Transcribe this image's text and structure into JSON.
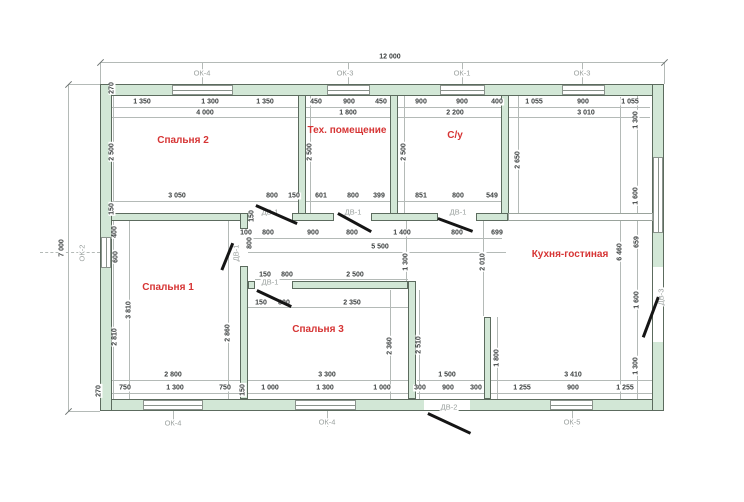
{
  "title": "План дома 12000 x 7000",
  "colors": {
    "wall_fill": "#d2e7d6",
    "wall_edge": "#5c6b5e",
    "dim_line": "#b4bab7",
    "dim_text": "#3c4040",
    "room_label": "#d63434",
    "axis_tag": "#9aa09e",
    "door_line": "#151515",
    "background": "#ffffff"
  },
  "plan": {
    "overall": {
      "width_mm": "12 000",
      "height_mm": "7 000"
    },
    "room_labels": [
      {
        "t": "Спальня 2",
        "x": 183,
        "y": 141
      },
      {
        "t": "Тех. помещение",
        "x": 347,
        "y": 131
      },
      {
        "t": "С/у",
        "x": 455,
        "y": 136
      },
      {
        "t": "Кухня-гостиная",
        "x": 570,
        "y": 255
      },
      {
        "t": "Спальня 1",
        "x": 168,
        "y": 288
      },
      {
        "t": "Спальня 3",
        "x": 318,
        "y": 330
      }
    ],
    "walls": [
      {
        "x": 100,
        "y": 84,
        "w": 564,
        "h": 12
      },
      {
        "x": 100,
        "y": 399,
        "w": 564,
        "h": 12
      },
      {
        "x": 100,
        "y": 84,
        "w": 12,
        "h": 327
      },
      {
        "x": 652,
        "y": 84,
        "w": 12,
        "h": 327
      },
      {
        "x": 298,
        "y": 95,
        "w": 8,
        "h": 126
      },
      {
        "x": 390,
        "y": 95,
        "w": 8,
        "h": 126
      },
      {
        "x": 501,
        "y": 95,
        "w": 8,
        "h": 126
      },
      {
        "x": 111,
        "y": 213,
        "w": 143,
        "h": 8
      },
      {
        "x": 292,
        "y": 213,
        "w": 42,
        "h": 8
      },
      {
        "x": 371,
        "y": 213,
        "w": 67,
        "h": 8
      },
      {
        "x": 476,
        "y": 213,
        "w": 32,
        "h": 8
      },
      {
        "x": 240,
        "y": 213,
        "w": 8,
        "h": 16
      },
      {
        "x": 240,
        "y": 266,
        "w": 8,
        "h": 133
      },
      {
        "x": 248,
        "y": 281,
        "w": 7,
        "h": 8
      },
      {
        "x": 292,
        "y": 281,
        "w": 116,
        "h": 8
      },
      {
        "x": 408,
        "y": 281,
        "w": 8,
        "h": 118
      },
      {
        "x": 484,
        "y": 317,
        "w": 7,
        "h": 82
      }
    ],
    "windows": [
      {
        "name": "ОК-4 top",
        "x": 172,
        "y": 85,
        "w": 61,
        "h": 10,
        "o": "h"
      },
      {
        "name": "ОК-3 top",
        "x": 327,
        "y": 85,
        "w": 43,
        "h": 10,
        "o": "h"
      },
      {
        "name": "ОК-1 top",
        "x": 440,
        "y": 85,
        "w": 45,
        "h": 10,
        "o": "h"
      },
      {
        "name": "ОК-3 top-2",
        "x": 562,
        "y": 85,
        "w": 43,
        "h": 10,
        "o": "h"
      },
      {
        "name": "ОК-4 bottom",
        "x": 143,
        "y": 400,
        "w": 60,
        "h": 10,
        "o": "h"
      },
      {
        "name": "ОК-4 bottom-2",
        "x": 295,
        "y": 400,
        "w": 61,
        "h": 10,
        "o": "h"
      },
      {
        "name": "ОК-5 bottom",
        "x": 550,
        "y": 400,
        "w": 43,
        "h": 10,
        "o": "h"
      },
      {
        "name": "ОК-2 left",
        "x": 101,
        "y": 237,
        "w": 10,
        "h": 31,
        "o": "v"
      },
      {
        "name": "окно right",
        "x": 653,
        "y": 157,
        "w": 10,
        "h": 76,
        "o": "v"
      }
    ],
    "openings": [
      {
        "name": "ДВ-2 проём",
        "x": 424,
        "y": 400,
        "w": 46,
        "h": 10
      },
      {
        "name": "ДВ-3 проём",
        "x": 653,
        "y": 267,
        "w": 10,
        "h": 75
      },
      {
        "name": "проём кухни",
        "x": 508,
        "y": 213,
        "w": 145,
        "h": 8,
        "b": 1
      }
    ],
    "doors": [
      {
        "name": "ДВ-1 спальня 2",
        "x1": 256,
        "y1": 204,
        "x2": 297,
        "y2": 222
      },
      {
        "name": "ДВ-1 тех.помещение",
        "x1": 338,
        "y1": 212,
        "x2": 371,
        "y2": 230
      },
      {
        "name": "ДВ-1 с/у",
        "x1": 438,
        "y1": 217,
        "x2": 473,
        "y2": 230
      },
      {
        "name": "ДВ-1 спальня 1",
        "x1": 233,
        "y1": 242,
        "x2": 222,
        "y2": 269
      },
      {
        "name": "ДВ-1 спальня 3",
        "x1": 257,
        "y1": 289,
        "x2": 291,
        "y2": 305
      },
      {
        "name": "ДВ-3 вход справа",
        "x1": 643,
        "y1": 336,
        "x2": 658,
        "y2": 296
      },
      {
        "name": "ДВ-2 вход снизу",
        "x1": 428,
        "y1": 412,
        "x2": 471,
        "y2": 432
      }
    ],
    "dims": [
      {
        "t": "12 000",
        "x": 390,
        "y": 57
      },
      {
        "t": "1 350",
        "x": 142,
        "y": 102
      },
      {
        "t": "1 300",
        "x": 210,
        "y": 102
      },
      {
        "t": "1 350",
        "x": 265,
        "y": 102
      },
      {
        "t": "450",
        "x": 316,
        "y": 102
      },
      {
        "t": "900",
        "x": 349,
        "y": 102
      },
      {
        "t": "450",
        "x": 381,
        "y": 102
      },
      {
        "t": "900",
        "x": 421,
        "y": 102
      },
      {
        "t": "900",
        "x": 462,
        "y": 102
      },
      {
        "t": "400",
        "x": 497,
        "y": 102
      },
      {
        "t": "1 055",
        "x": 534,
        "y": 102
      },
      {
        "t": "900",
        "x": 583,
        "y": 102
      },
      {
        "t": "1 055",
        "x": 630,
        "y": 102
      },
      {
        "t": "4 000",
        "x": 205,
        "y": 113
      },
      {
        "t": "1 800",
        "x": 348,
        "y": 113
      },
      {
        "t": "2 200",
        "x": 455,
        "y": 113
      },
      {
        "t": "3 010",
        "x": 586,
        "y": 113
      },
      {
        "t": "3 050",
        "x": 177,
        "y": 196
      },
      {
        "t": "800",
        "x": 272,
        "y": 196
      },
      {
        "t": "150",
        "x": 294,
        "y": 196
      },
      {
        "t": "601",
        "x": 321,
        "y": 196
      },
      {
        "t": "800",
        "x": 353,
        "y": 196
      },
      {
        "t": "399",
        "x": 379,
        "y": 196
      },
      {
        "t": "851",
        "x": 421,
        "y": 196
      },
      {
        "t": "800",
        "x": 458,
        "y": 196
      },
      {
        "t": "549",
        "x": 492,
        "y": 196
      },
      {
        "t": "100",
        "x": 246,
        "y": 233
      },
      {
        "t": "800",
        "x": 268,
        "y": 233
      },
      {
        "t": "900",
        "x": 313,
        "y": 233
      },
      {
        "t": "800",
        "x": 352,
        "y": 233
      },
      {
        "t": "1 400",
        "x": 402,
        "y": 233
      },
      {
        "t": "800",
        "x": 457,
        "y": 233
      },
      {
        "t": "699",
        "x": 497,
        "y": 233
      },
      {
        "t": "5 500",
        "x": 380,
        "y": 247
      },
      {
        "t": "150",
        "x": 265,
        "y": 275
      },
      {
        "t": "800",
        "x": 287,
        "y": 275
      },
      {
        "t": "2 500",
        "x": 355,
        "y": 275
      },
      {
        "t": "150",
        "x": 261,
        "y": 303
      },
      {
        "t": "800",
        "x": 284,
        "y": 303
      },
      {
        "t": "2 350",
        "x": 352,
        "y": 303
      },
      {
        "t": "2 800",
        "x": 173,
        "y": 375
      },
      {
        "t": "3 300",
        "x": 327,
        "y": 375
      },
      {
        "t": "1 500",
        "x": 447,
        "y": 375
      },
      {
        "t": "3 410",
        "x": 573,
        "y": 375
      },
      {
        "t": "750",
        "x": 125,
        "y": 388
      },
      {
        "t": "1 300",
        "x": 175,
        "y": 388
      },
      {
        "t": "750",
        "x": 225,
        "y": 388
      },
      {
        "t": "1 000",
        "x": 270,
        "y": 388
      },
      {
        "t": "1 300",
        "x": 325,
        "y": 388
      },
      {
        "t": "1 000",
        "x": 382,
        "y": 388
      },
      {
        "t": "300",
        "x": 420,
        "y": 388
      },
      {
        "t": "900",
        "x": 448,
        "y": 388
      },
      {
        "t": "300",
        "x": 476,
        "y": 388
      },
      {
        "t": "1 255",
        "x": 522,
        "y": 388
      },
      {
        "t": "900",
        "x": 573,
        "y": 388
      },
      {
        "t": "1 255",
        "x": 625,
        "y": 388
      },
      {
        "t": "7 000",
        "x": 62,
        "y": 248,
        "r": 1
      },
      {
        "t": "270",
        "x": 112,
        "y": 88,
        "r": 1
      },
      {
        "t": "2 500",
        "x": 112,
        "y": 152,
        "r": 1
      },
      {
        "t": "150",
        "x": 112,
        "y": 209,
        "r": 1
      },
      {
        "t": "400",
        "x": 115,
        "y": 232,
        "r": 1
      },
      {
        "t": "600",
        "x": 116,
        "y": 257,
        "r": 1
      },
      {
        "t": "2 810",
        "x": 115,
        "y": 337,
        "r": 1
      },
      {
        "t": "3 810",
        "x": 129,
        "y": 310,
        "r": 1
      },
      {
        "t": "270",
        "x": 99,
        "y": 391,
        "r": 1
      },
      {
        "t": "150",
        "x": 243,
        "y": 390,
        "r": 1
      },
      {
        "t": "2 500",
        "x": 310,
        "y": 152,
        "r": 1
      },
      {
        "t": "2 500",
        "x": 404,
        "y": 152,
        "r": 1
      },
      {
        "t": "2 650",
        "x": 518,
        "y": 160,
        "r": 1
      },
      {
        "t": "1 300",
        "x": 636,
        "y": 120,
        "r": 1
      },
      {
        "t": "1 600",
        "x": 636,
        "y": 196,
        "r": 1
      },
      {
        "t": "6 460",
        "x": 620,
        "y": 252,
        "r": 1
      },
      {
        "t": "659",
        "x": 637,
        "y": 242,
        "r": 1
      },
      {
        "t": "1 600",
        "x": 637,
        "y": 300,
        "r": 1
      },
      {
        "t": "1 300",
        "x": 636,
        "y": 366,
        "r": 1
      },
      {
        "t": "1 300",
        "x": 406,
        "y": 262,
        "r": 1
      },
      {
        "t": "2 010",
        "x": 483,
        "y": 262,
        "r": 1
      },
      {
        "t": "2 860",
        "x": 228,
        "y": 333,
        "r": 1
      },
      {
        "t": "2 360",
        "x": 390,
        "y": 346,
        "r": 1
      },
      {
        "t": "2 510",
        "x": 419,
        "y": 345,
        "r": 1
      },
      {
        "t": "1 800",
        "x": 497,
        "y": 358,
        "r": 1
      },
      {
        "t": "150",
        "x": 252,
        "y": 216,
        "r": 1
      },
      {
        "t": "800",
        "x": 250,
        "y": 243,
        "r": 1
      }
    ],
    "tags": [
      {
        "t": "ОК-4",
        "x": 202,
        "y": 73
      },
      {
        "t": "ОК-3",
        "x": 345,
        "y": 73
      },
      {
        "t": "ОК-1",
        "x": 462,
        "y": 73
      },
      {
        "t": "ОК-3",
        "x": 582,
        "y": 73
      },
      {
        "t": "ОК-2",
        "x": 82,
        "y": 253,
        "r": 1
      },
      {
        "t": "ОК-4",
        "x": 173,
        "y": 423
      },
      {
        "t": "ОК-4",
        "x": 327,
        "y": 422
      },
      {
        "t": "ОК-5",
        "x": 572,
        "y": 422
      },
      {
        "t": "ДВ-2",
        "x": 449,
        "y": 407
      },
      {
        "t": "ДВ-1",
        "x": 270,
        "y": 212
      },
      {
        "t": "ДВ-1",
        "x": 353,
        "y": 212
      },
      {
        "t": "ДВ-1",
        "x": 458,
        "y": 212
      },
      {
        "t": "ДВ-1",
        "x": 236,
        "y": 253,
        "r": 1
      },
      {
        "t": "ДВ-1",
        "x": 270,
        "y": 282
      },
      {
        "t": "ДВ-3",
        "x": 661,
        "y": 297,
        "r": 1
      }
    ],
    "dlines": [
      {
        "x": 100,
        "y": 62,
        "w": 564,
        "h": 1
      },
      {
        "x": 68,
        "y": 84,
        "w": 1,
        "h": 327
      },
      {
        "x": 111,
        "y": 107,
        "w": 188,
        "h": 1
      },
      {
        "x": 306,
        "y": 107,
        "w": 85,
        "h": 1
      },
      {
        "x": 398,
        "y": 107,
        "w": 104,
        "h": 1
      },
      {
        "x": 508,
        "y": 107,
        "w": 142,
        "h": 1
      },
      {
        "x": 111,
        "y": 117,
        "w": 188,
        "h": 1
      },
      {
        "x": 306,
        "y": 117,
        "w": 85,
        "h": 1
      },
      {
        "x": 398,
        "y": 117,
        "w": 104,
        "h": 1
      },
      {
        "x": 508,
        "y": 117,
        "w": 142,
        "h": 1
      },
      {
        "x": 111,
        "y": 201,
        "w": 188,
        "h": 1
      },
      {
        "x": 306,
        "y": 201,
        "w": 85,
        "h": 1
      },
      {
        "x": 398,
        "y": 201,
        "w": 104,
        "h": 1
      },
      {
        "x": 248,
        "y": 238,
        "w": 254,
        "h": 1
      },
      {
        "x": 248,
        "y": 252,
        "w": 258,
        "h": 1
      },
      {
        "x": 255,
        "y": 279,
        "w": 153,
        "h": 1
      },
      {
        "x": 248,
        "y": 307,
        "w": 160,
        "h": 1
      },
      {
        "x": 111,
        "y": 380,
        "w": 130,
        "h": 1
      },
      {
        "x": 248,
        "y": 380,
        "w": 160,
        "h": 1
      },
      {
        "x": 417,
        "y": 380,
        "w": 68,
        "h": 1
      },
      {
        "x": 490,
        "y": 380,
        "w": 163,
        "h": 1
      },
      {
        "x": 111,
        "y": 393,
        "w": 130,
        "h": 1
      },
      {
        "x": 248,
        "y": 393,
        "w": 160,
        "h": 1
      },
      {
        "x": 417,
        "y": 393,
        "w": 68,
        "h": 1
      },
      {
        "x": 490,
        "y": 393,
        "w": 163,
        "h": 1
      },
      {
        "x": 113,
        "y": 95,
        "w": 1,
        "h": 304
      },
      {
        "x": 129,
        "y": 219,
        "w": 1,
        "h": 180
      },
      {
        "x": 310,
        "y": 95,
        "w": 1,
        "h": 118
      },
      {
        "x": 404,
        "y": 95,
        "w": 1,
        "h": 118
      },
      {
        "x": 518,
        "y": 95,
        "w": 1,
        "h": 118
      },
      {
        "x": 620,
        "y": 97,
        "w": 1,
        "h": 302
      },
      {
        "x": 637,
        "y": 95,
        "w": 1,
        "h": 304
      },
      {
        "x": 406,
        "y": 221,
        "w": 1,
        "h": 60
      },
      {
        "x": 483,
        "y": 221,
        "w": 1,
        "h": 95
      },
      {
        "x": 228,
        "y": 221,
        "w": 1,
        "h": 178
      },
      {
        "x": 390,
        "y": 290,
        "w": 1,
        "h": 109
      },
      {
        "x": 419,
        "y": 290,
        "w": 1,
        "h": 109
      },
      {
        "x": 497,
        "y": 317,
        "w": 1,
        "h": 82
      },
      {
        "x": 100,
        "y": 62,
        "w": 1,
        "h": 22
      },
      {
        "x": 664,
        "y": 62,
        "w": 1,
        "h": 22
      },
      {
        "x": 68,
        "y": 84,
        "w": 32,
        "h": 1
      },
      {
        "x": 68,
        "y": 411,
        "w": 32,
        "h": 1
      },
      {
        "x": 202,
        "y": 62,
        "w": 1,
        "h": 23
      },
      {
        "x": 348,
        "y": 62,
        "w": 1,
        "h": 23
      },
      {
        "x": 462,
        "y": 62,
        "w": 1,
        "h": 23
      },
      {
        "x": 582,
        "y": 62,
        "w": 1,
        "h": 23
      },
      {
        "x": 173,
        "y": 411,
        "w": 1,
        "h": 16
      },
      {
        "x": 327,
        "y": 411,
        "w": 1,
        "h": 16
      },
      {
        "x": 572,
        "y": 411,
        "w": 1,
        "h": 16
      },
      {
        "x": 40,
        "y": 252,
        "w": 60,
        "h": 1,
        "dash": 1
      }
    ],
    "ticks": [
      {
        "x": 96,
        "y": 62
      },
      {
        "x": 660,
        "y": 62
      },
      {
        "x": 64,
        "y": 84
      },
      {
        "x": 64,
        "y": 411
      }
    ]
  }
}
